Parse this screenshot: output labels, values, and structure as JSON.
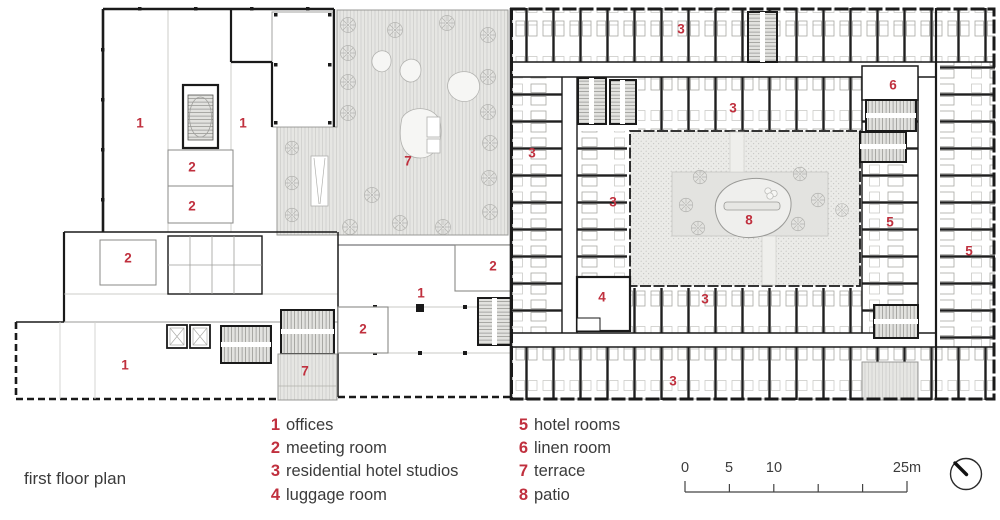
{
  "title": "first floor plan",
  "legend": {
    "columns": [
      {
        "items": [
          {
            "number": "1",
            "label": "offices"
          },
          {
            "number": "2",
            "label": "meeting room"
          },
          {
            "number": "3",
            "label": "residential hotel studios"
          },
          {
            "number": "4",
            "label": "luggage room"
          }
        ]
      },
      {
        "items": [
          {
            "number": "5",
            "label": "hotel rooms"
          },
          {
            "number": "6",
            "label": "linen room"
          },
          {
            "number": "7",
            "label": "terrace"
          },
          {
            "number": "8",
            "label": "patio"
          }
        ]
      }
    ]
  },
  "scale_bar": {
    "labels": [
      "0",
      "5",
      "10",
      "25m"
    ]
  },
  "plan_labels": [
    {
      "n": "1",
      "x": 140,
      "y": 123
    },
    {
      "n": "1",
      "x": 243,
      "y": 123
    },
    {
      "n": "1",
      "x": 421,
      "y": 293
    },
    {
      "n": "1",
      "x": 125,
      "y": 365
    },
    {
      "n": "2",
      "x": 192,
      "y": 167
    },
    {
      "n": "2",
      "x": 192,
      "y": 206
    },
    {
      "n": "2",
      "x": 128,
      "y": 258
    },
    {
      "n": "2",
      "x": 493,
      "y": 266
    },
    {
      "n": "2",
      "x": 363,
      "y": 329
    },
    {
      "n": "3",
      "x": 681,
      "y": 29
    },
    {
      "n": "3",
      "x": 733,
      "y": 108
    },
    {
      "n": "3",
      "x": 532,
      "y": 153
    },
    {
      "n": "3",
      "x": 613,
      "y": 202
    },
    {
      "n": "3",
      "x": 705,
      "y": 299
    },
    {
      "n": "3",
      "x": 673,
      "y": 381
    },
    {
      "n": "4",
      "x": 602,
      "y": 297
    },
    {
      "n": "5",
      "x": 890,
      "y": 222
    },
    {
      "n": "5",
      "x": 969,
      "y": 251
    },
    {
      "n": "6",
      "x": 893,
      "y": 85
    },
    {
      "n": "7",
      "x": 408,
      "y": 161
    },
    {
      "n": "7",
      "x": 305,
      "y": 371
    },
    {
      "n": "8",
      "x": 749,
      "y": 220
    }
  ],
  "colors": {
    "label_red": "#c0303e",
    "wall": "#1a1a1a",
    "text": "#3b3b3b",
    "terrace_fill": "#e6e6e3",
    "patio_fill": "#ebebe8"
  },
  "icons": {
    "compass": "north-needle-icon",
    "trees": "tree-icon",
    "stairs": "stair-icon"
  }
}
